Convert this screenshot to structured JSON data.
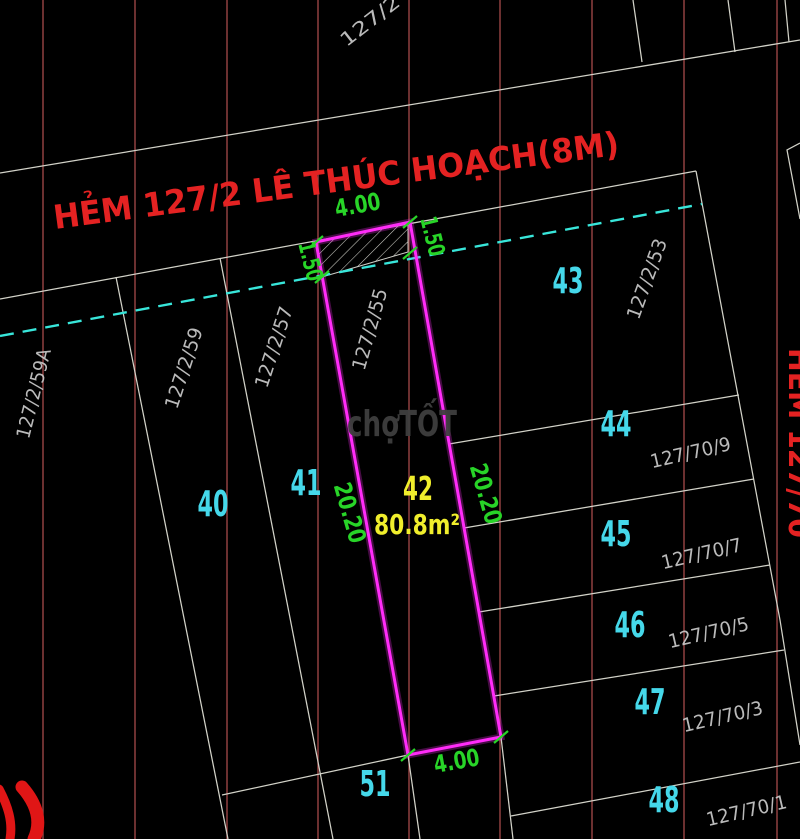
{
  "street_name": "HẺM 127/2  LÊ THÚC HOẠCH(8M)",
  "alley_name": "HẺM 127/70",
  "block_ref": "127/2",
  "subject_plot": {
    "number": "42",
    "area": "80.8m²",
    "address": "127/2/55",
    "dims": {
      "front": "4.00",
      "back": "4.00",
      "side_left": "20.20",
      "side_right": "20.20",
      "setback_left": "1.50",
      "setback_right": "1.50"
    }
  },
  "parcels": [
    "40",
    "41",
    "43",
    "44",
    "45",
    "46",
    "47",
    "48",
    "51"
  ],
  "addresses": [
    "127/2/59A",
    "127/2/59",
    "127/2/57",
    "127/2/53",
    "127/70/9",
    "127/70/7",
    "127/70/5",
    "127/70/3",
    "127/70/1"
  ],
  "watermark": {
    "part1": "chợ",
    "part2": "TỐT"
  },
  "colors": {
    "background": "#000000",
    "grid_line": "#9a4545",
    "parcel_line": "#d2d2c8",
    "planning_line": "#38e6da",
    "plot_outline": "#ff2cf8",
    "dimension_text": "#28d428",
    "parcel_number_text": "#45d8ea",
    "plot_label_text": "#f0ee2c",
    "street_text": "#e42222",
    "address_text": "#c9c9c9",
    "watermark_text": "#3f3f3f"
  }
}
